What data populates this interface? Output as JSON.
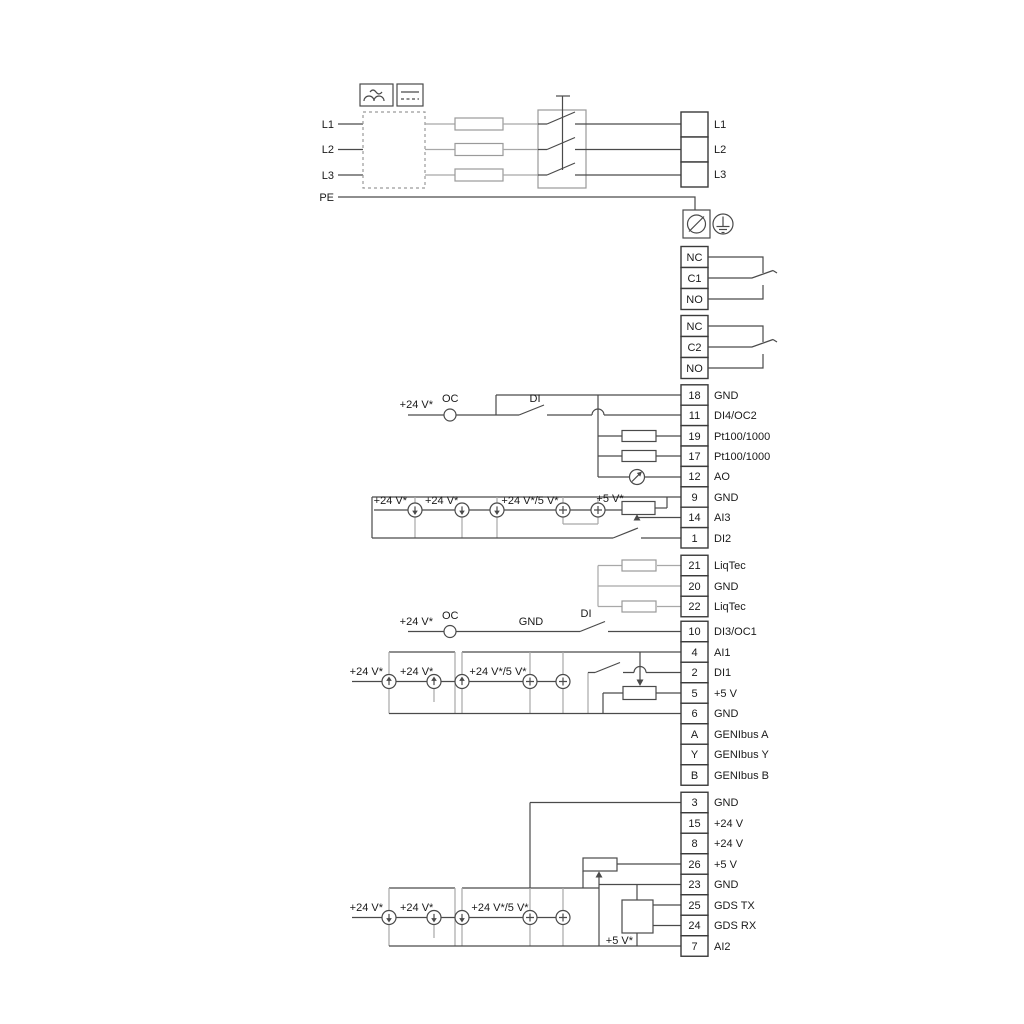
{
  "power": {
    "inputs": [
      "L1",
      "L2",
      "L3",
      "PE"
    ],
    "outputs": [
      "L1",
      "L2",
      "L3"
    ]
  },
  "relays": {
    "relay1": [
      "NC",
      "C1",
      "NO"
    ],
    "relay2": [
      "NC",
      "C2",
      "NO"
    ]
  },
  "io1": {
    "rows": [
      {
        "num": "18",
        "label": "GND"
      },
      {
        "num": "11",
        "label": "DI4/OC2"
      },
      {
        "num": "19",
        "label": "Pt100/1000"
      },
      {
        "num": "17",
        "label": "Pt100/1000"
      },
      {
        "num": "12",
        "label": "AO"
      },
      {
        "num": "9",
        "label": "GND"
      },
      {
        "num": "14",
        "label": "AI3"
      },
      {
        "num": "1",
        "label": "DI2"
      }
    ]
  },
  "liqtec": {
    "rows": [
      {
        "num": "21",
        "label": "LiqTec"
      },
      {
        "num": "20",
        "label": "GND"
      },
      {
        "num": "22",
        "label": "LiqTec"
      }
    ]
  },
  "io2": {
    "rows": [
      {
        "num": "10",
        "label": "DI3/OC1"
      },
      {
        "num": "4",
        "label": "AI1"
      },
      {
        "num": "2",
        "label": "DI1"
      },
      {
        "num": "5",
        "label": "+5 V"
      },
      {
        "num": "6",
        "label": "GND"
      },
      {
        "num": "A",
        "label": "GENIbus A"
      },
      {
        "num": "Y",
        "label": "GENIbus Y"
      },
      {
        "num": "B",
        "label": "GENIbus B"
      }
    ]
  },
  "io3": {
    "rows": [
      {
        "num": "3",
        "label": "GND"
      },
      {
        "num": "15",
        "label": "+24 V"
      },
      {
        "num": "8",
        "label": "+24 V"
      },
      {
        "num": "26",
        "label": "+5 V"
      },
      {
        "num": "23",
        "label": "GND"
      },
      {
        "num": "25",
        "label": "GDS TX"
      },
      {
        "num": "24",
        "label": "GDS RX"
      },
      {
        "num": "7",
        "label": "AI2"
      }
    ]
  },
  "ann": {
    "di4_supply": "+24 V*",
    "di4_oc": "OC",
    "di4_di": "DI",
    "g1": [
      "+24 V*",
      "+24 V*",
      "+24 V*/5 V*",
      "+5 V*"
    ],
    "di3_supply": "+24 V*",
    "di3_oc": "OC",
    "di3_gnd": "GND",
    "di3_di": "DI",
    "g3": [
      "+24 V*",
      "+24 V*",
      "+24 V*/5 V*"
    ],
    "g4": [
      "+24 V*",
      "+24 V*",
      "+24 V*/5 V*"
    ],
    "gds_supply": "+5 V*"
  },
  "colors": {
    "wire": "#4a4a4a",
    "wire_gray": "#a8a8a8",
    "text": "#1a1a1a",
    "background": "#ffffff"
  }
}
